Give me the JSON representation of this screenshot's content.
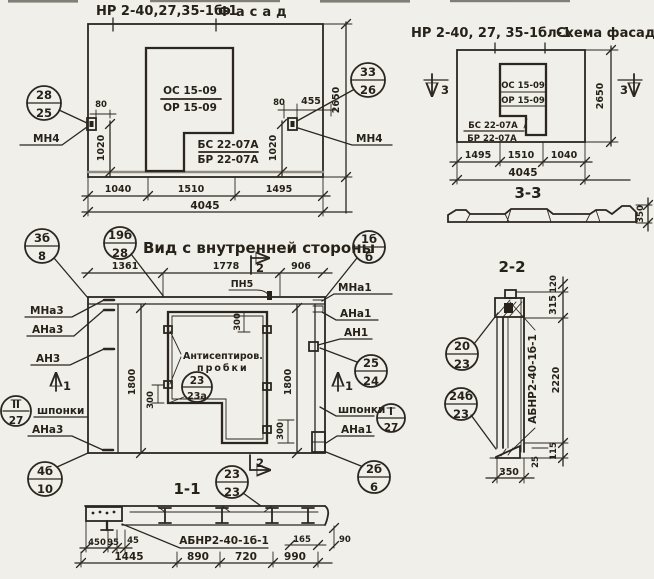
{
  "facade": {
    "title_code": "НР 2-40,27,35-1б-1",
    "title_name": "Фасад",
    "os": "ОС 15-09",
    "or": "ОР 15-09",
    "bs": "БС 22-07А",
    "br": "БР 22-07А",
    "c_left_top": "28",
    "c_left_bot": "25",
    "c_right_top": "33",
    "c_right_bot": "26",
    "mn4_left": "МН4",
    "mn4_right": "МН4",
    "d80l": "80",
    "d80r": "80",
    "d455": "455",
    "d1020l": "1020",
    "d1020r": "1020",
    "d2650": "2650",
    "d1040": "1040",
    "d1510": "1510",
    "d1495": "1495",
    "d4045": "4045"
  },
  "scheme": {
    "title_code": "НР 2-40, 27, 35-1бл-1",
    "title_name": "Схема фасада",
    "os": "ОС 15-09",
    "or": "ОР 15-09",
    "bs": "БС 22-07А",
    "br": "БР 22-07А",
    "m3l": "3",
    "m3r": "3",
    "d2650": "2650",
    "d1495": "1495",
    "d1510": "1510",
    "d1040": "1040",
    "d4045": "4045"
  },
  "sec33": {
    "label": "3-3",
    "d350": "350"
  },
  "inner": {
    "title": "Вид с внутренней стороны",
    "c1t": "3б",
    "c1b": "8",
    "c2t": "19б",
    "c2b": "28",
    "c3t": "1б",
    "c3b": "б",
    "d1361": "1361",
    "d1778": "1778",
    "d906": "906",
    "pn5": "ПН5",
    "m2t": "2",
    "m2b": "2",
    "m1l": "1",
    "m1r": "1",
    "mna3": "МНа3",
    "ana3": "АНа3",
    "an3": "АН3",
    "ana3_low": "АНа3",
    "mna1": "МНа1",
    "ana1": "АНа1",
    "an1": "АН1",
    "ana1_low": "АНа1",
    "shp_l": "шпонки",
    "shp_r": "шпонки",
    "cii_t": "II",
    "cii_b": "27",
    "ci_t": "I",
    "ci_b": "27",
    "c2524t": "25",
    "c2524b": "24",
    "c4bt": "4б",
    "c4bb": "10",
    "c2bt": "2б",
    "c2bb": "6",
    "cplug_t": "23",
    "cplug_b": "23а",
    "note1": "Антисептиров.",
    "note2": "пробки",
    "d1800l": "1800",
    "d1800r": "1800",
    "d300t": "300",
    "d300l": "300",
    "d300r": "300"
  },
  "sec11": {
    "label": "1-1",
    "ct": "23",
    "cb": "23",
    "mark": "АБНР2-40-1б-1",
    "d450": "450",
    "d95": "95",
    "d45": "45",
    "d1445": "1445",
    "d890": "890",
    "d720": "720",
    "d990": "990",
    "d165": "165",
    "d90": "90"
  },
  "sec22": {
    "label": "2-2",
    "mark": "АБНР2-40-1б-1",
    "c1t": "20",
    "c1b": "23",
    "c2t": "24б",
    "c2b": "23",
    "d120": "120",
    "d315": "315",
    "d2220": "2220",
    "d115": "115",
    "d25": "25",
    "d350": "350"
  }
}
